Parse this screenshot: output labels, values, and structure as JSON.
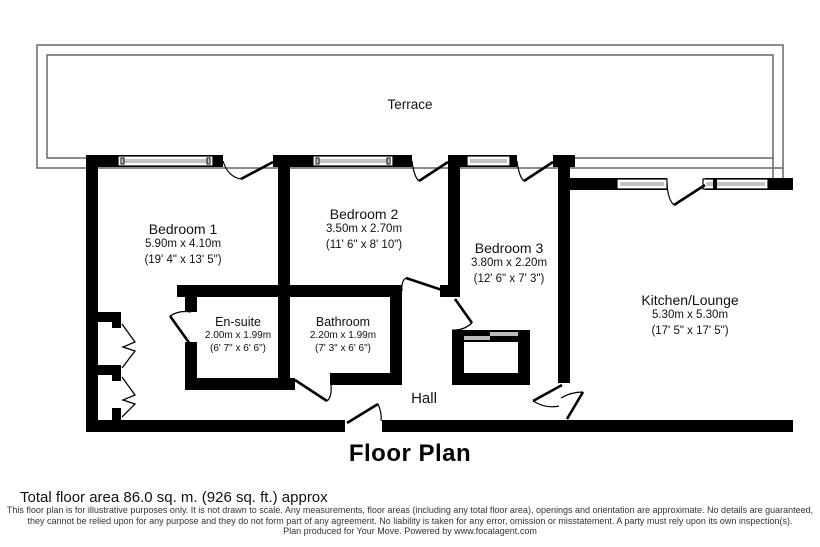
{
  "page": {
    "title": "Floor Plan"
  },
  "terrace": {
    "label": "Terrace"
  },
  "hall": {
    "label": "Hall"
  },
  "rooms": {
    "bedroom1": {
      "name": "Bedroom 1",
      "metric": "5.90m x 4.10m",
      "imperial": "(19' 4\" x 13' 5\")"
    },
    "bedroom2": {
      "name": "Bedroom 2",
      "metric": "3.50m x 2.70m",
      "imperial": "(11' 6\" x 8' 10\")"
    },
    "bedroom3": {
      "name": "Bedroom 3",
      "metric": "3.80m x 2.20m",
      "imperial": "(12' 6\" x 7' 3\")"
    },
    "ensuite": {
      "name": "En-suite",
      "metric": "2.00m x 1.99m",
      "imperial": "(6' 7\" x 6' 6\")"
    },
    "bathroom": {
      "name": "Bathroom",
      "metric": "2.20m x 1.99m",
      "imperial": "(7' 3\" x 6' 6\")"
    },
    "kitchen": {
      "name": "Kitchen/Lounge",
      "metric": "5.30m x 5.30m",
      "imperial": "(17' 5\" x 17' 5\")"
    }
  },
  "footer": {
    "total_area": "Total floor area 86.0 sq. m. (926 sq. ft.) approx",
    "disclaimer_line1": "This floor plan is for illustrative purposes only. It is not drawn to scale. Any measurements, floor areas (including any total floor area), openings and orientation are approximate. No details are guaranteed,",
    "disclaimer_line2": "they cannot be relied upon for any purpose and they do not form part of any agreement. No liability is taken for any error, omission or misstatement. A party must rely upon its own inspection(s).",
    "credit": "Plan produced for Your Move. Powered by www.focalagent.com"
  },
  "colors": {
    "wall": "#000000",
    "background": "#ffffff",
    "terrace_line": "#666666",
    "window_pane": "#888888",
    "sliding_door": "#bbbbbb"
  }
}
